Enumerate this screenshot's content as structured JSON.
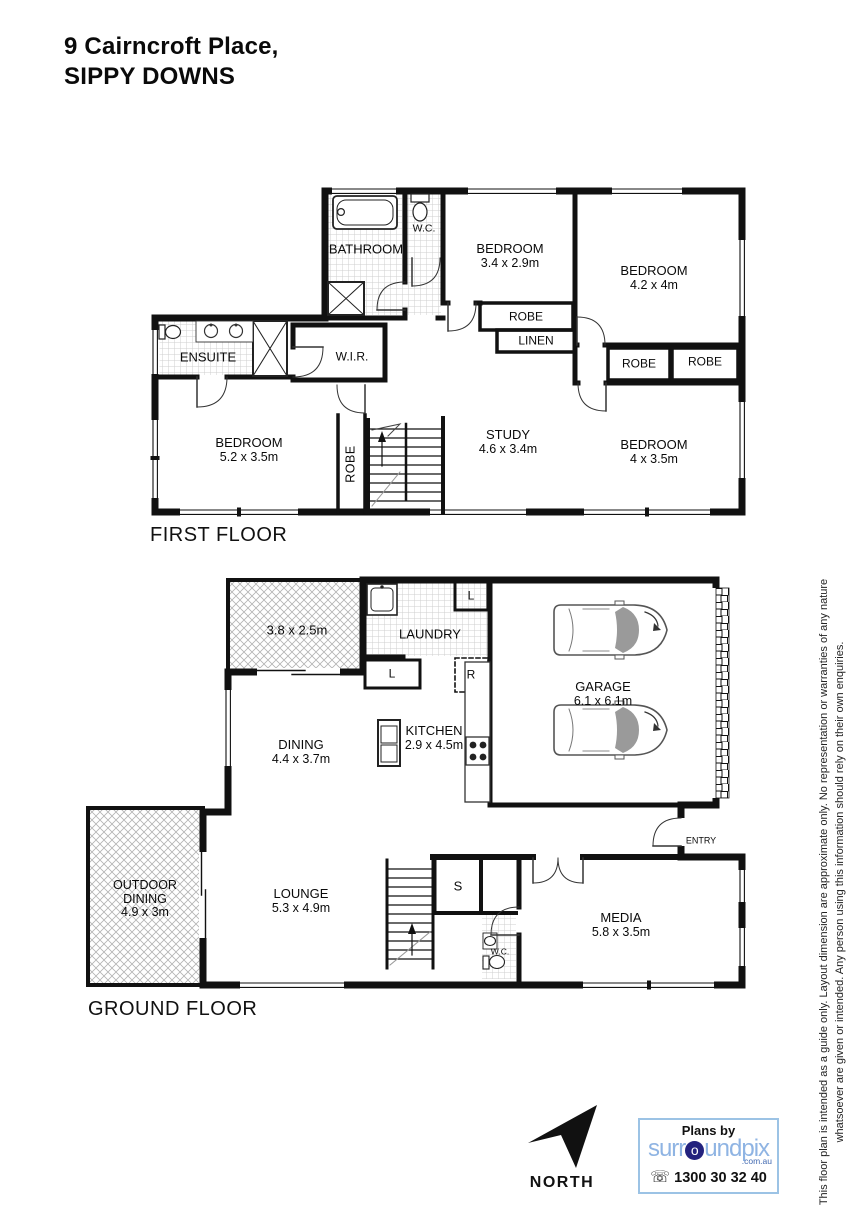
{
  "title": {
    "line1": "9 Cairncroft Place,",
    "line2": "SIPPY DOWNS"
  },
  "first_floor": {
    "section_label": "FIRST FLOOR",
    "bathroom": {
      "name": "BATHROOM"
    },
    "wc": {
      "name": "W.C."
    },
    "bedroom_1": {
      "name": "BEDROOM",
      "dim": "3.4 x 2.9m"
    },
    "bedroom_2": {
      "name": "BEDROOM",
      "dim": "4.2 x 4m"
    },
    "bedroom_3": {
      "name": "BEDROOM",
      "dim": "5.2 x 3.5m"
    },
    "bedroom_4": {
      "name": "BEDROOM",
      "dim": "4 x 3.5m"
    },
    "study": {
      "name": "STUDY",
      "dim": "4.6 x 3.4m"
    },
    "ensuite": {
      "name": "ENSUITE"
    },
    "wir": {
      "name": "W.I.R."
    },
    "robe_bed1": {
      "name": "ROBE"
    },
    "linen": {
      "name": "LINEN"
    },
    "robe_bed2_left": {
      "name": "ROBE"
    },
    "robe_bed2_right": {
      "name": "ROBE"
    },
    "robe_hall": {
      "name": "ROBE"
    }
  },
  "ground_floor": {
    "section_label": "GROUND FLOOR",
    "patio": {
      "dim": "3.8 x 2.5m"
    },
    "laundry": {
      "name": "LAUNDRY"
    },
    "linen_cupboard_top": {
      "name": "L"
    },
    "linen_cupboard_left": {
      "name": "L"
    },
    "fridge_space": {
      "name": "R"
    },
    "garage": {
      "name": "GARAGE",
      "dim": "6.1 x 6.1m"
    },
    "dining": {
      "name": "DINING",
      "dim": "4.4 x 3.7m"
    },
    "kitchen": {
      "name": "KITCHEN",
      "dim": "2.9 x 4.5m"
    },
    "outdoor_dining": {
      "line1": "OUTDOOR",
      "line2": "DINING",
      "dim": "4.9 x 3m"
    },
    "lounge": {
      "name": "LOUNGE",
      "dim": "5.3 x 4.9m"
    },
    "storage": {
      "name": "S"
    },
    "wc": {
      "name": "W.C."
    },
    "media": {
      "name": "MEDIA",
      "dim": "5.8 x 3.5m"
    },
    "entry": {
      "name": "ENTRY"
    }
  },
  "compass": {
    "label": "NORTH"
  },
  "branding": {
    "plans_by": "Plans by",
    "brand_pre": "surr",
    "brand_o": "o",
    "brand_post": "undpix",
    "brand_domain": ".com.au",
    "phone_icon": "☏",
    "phone": "1300 30 32 40"
  },
  "disclaimer": {
    "line1": "This floor plan is intended as a guide only. Layout dimension are approximate only. No representation or warranties of any nature",
    "line2": "whatsoever are given or intended. Any person using this information should rely on their own enquiries."
  }
}
